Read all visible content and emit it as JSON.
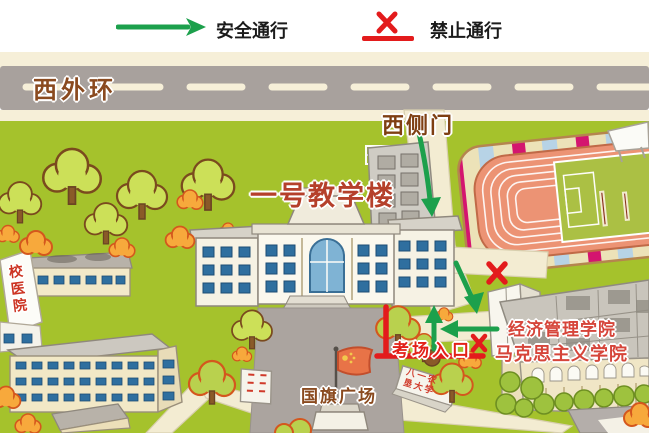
{
  "legend": {
    "safe": "安全通行",
    "forbidden": "禁止通行"
  },
  "map": {
    "road": "西外环",
    "west_gate": "西侧门",
    "teaching": "一号教学楼",
    "field": "二号",
    "econ": "经济管理学院",
    "marx": "马克思主义学院",
    "entrance": "考场入口",
    "plaza": "国旗广场",
    "clinic": "校医院",
    "monument": "八一农垦大学"
  },
  "icons": {
    "safe_route": "green-arrow",
    "blocked_route": "red-x"
  },
  "colors": {
    "safe_green": "#1ca04c",
    "block_red": "#e31b1c",
    "road_gray": "#a8a19d",
    "grass_green": "#a5c22c",
    "track_orange": "#ec9374",
    "stripe_magenta": "#d4156f",
    "label_brown": "#8a4a1f",
    "label_red": "#d6453a"
  }
}
